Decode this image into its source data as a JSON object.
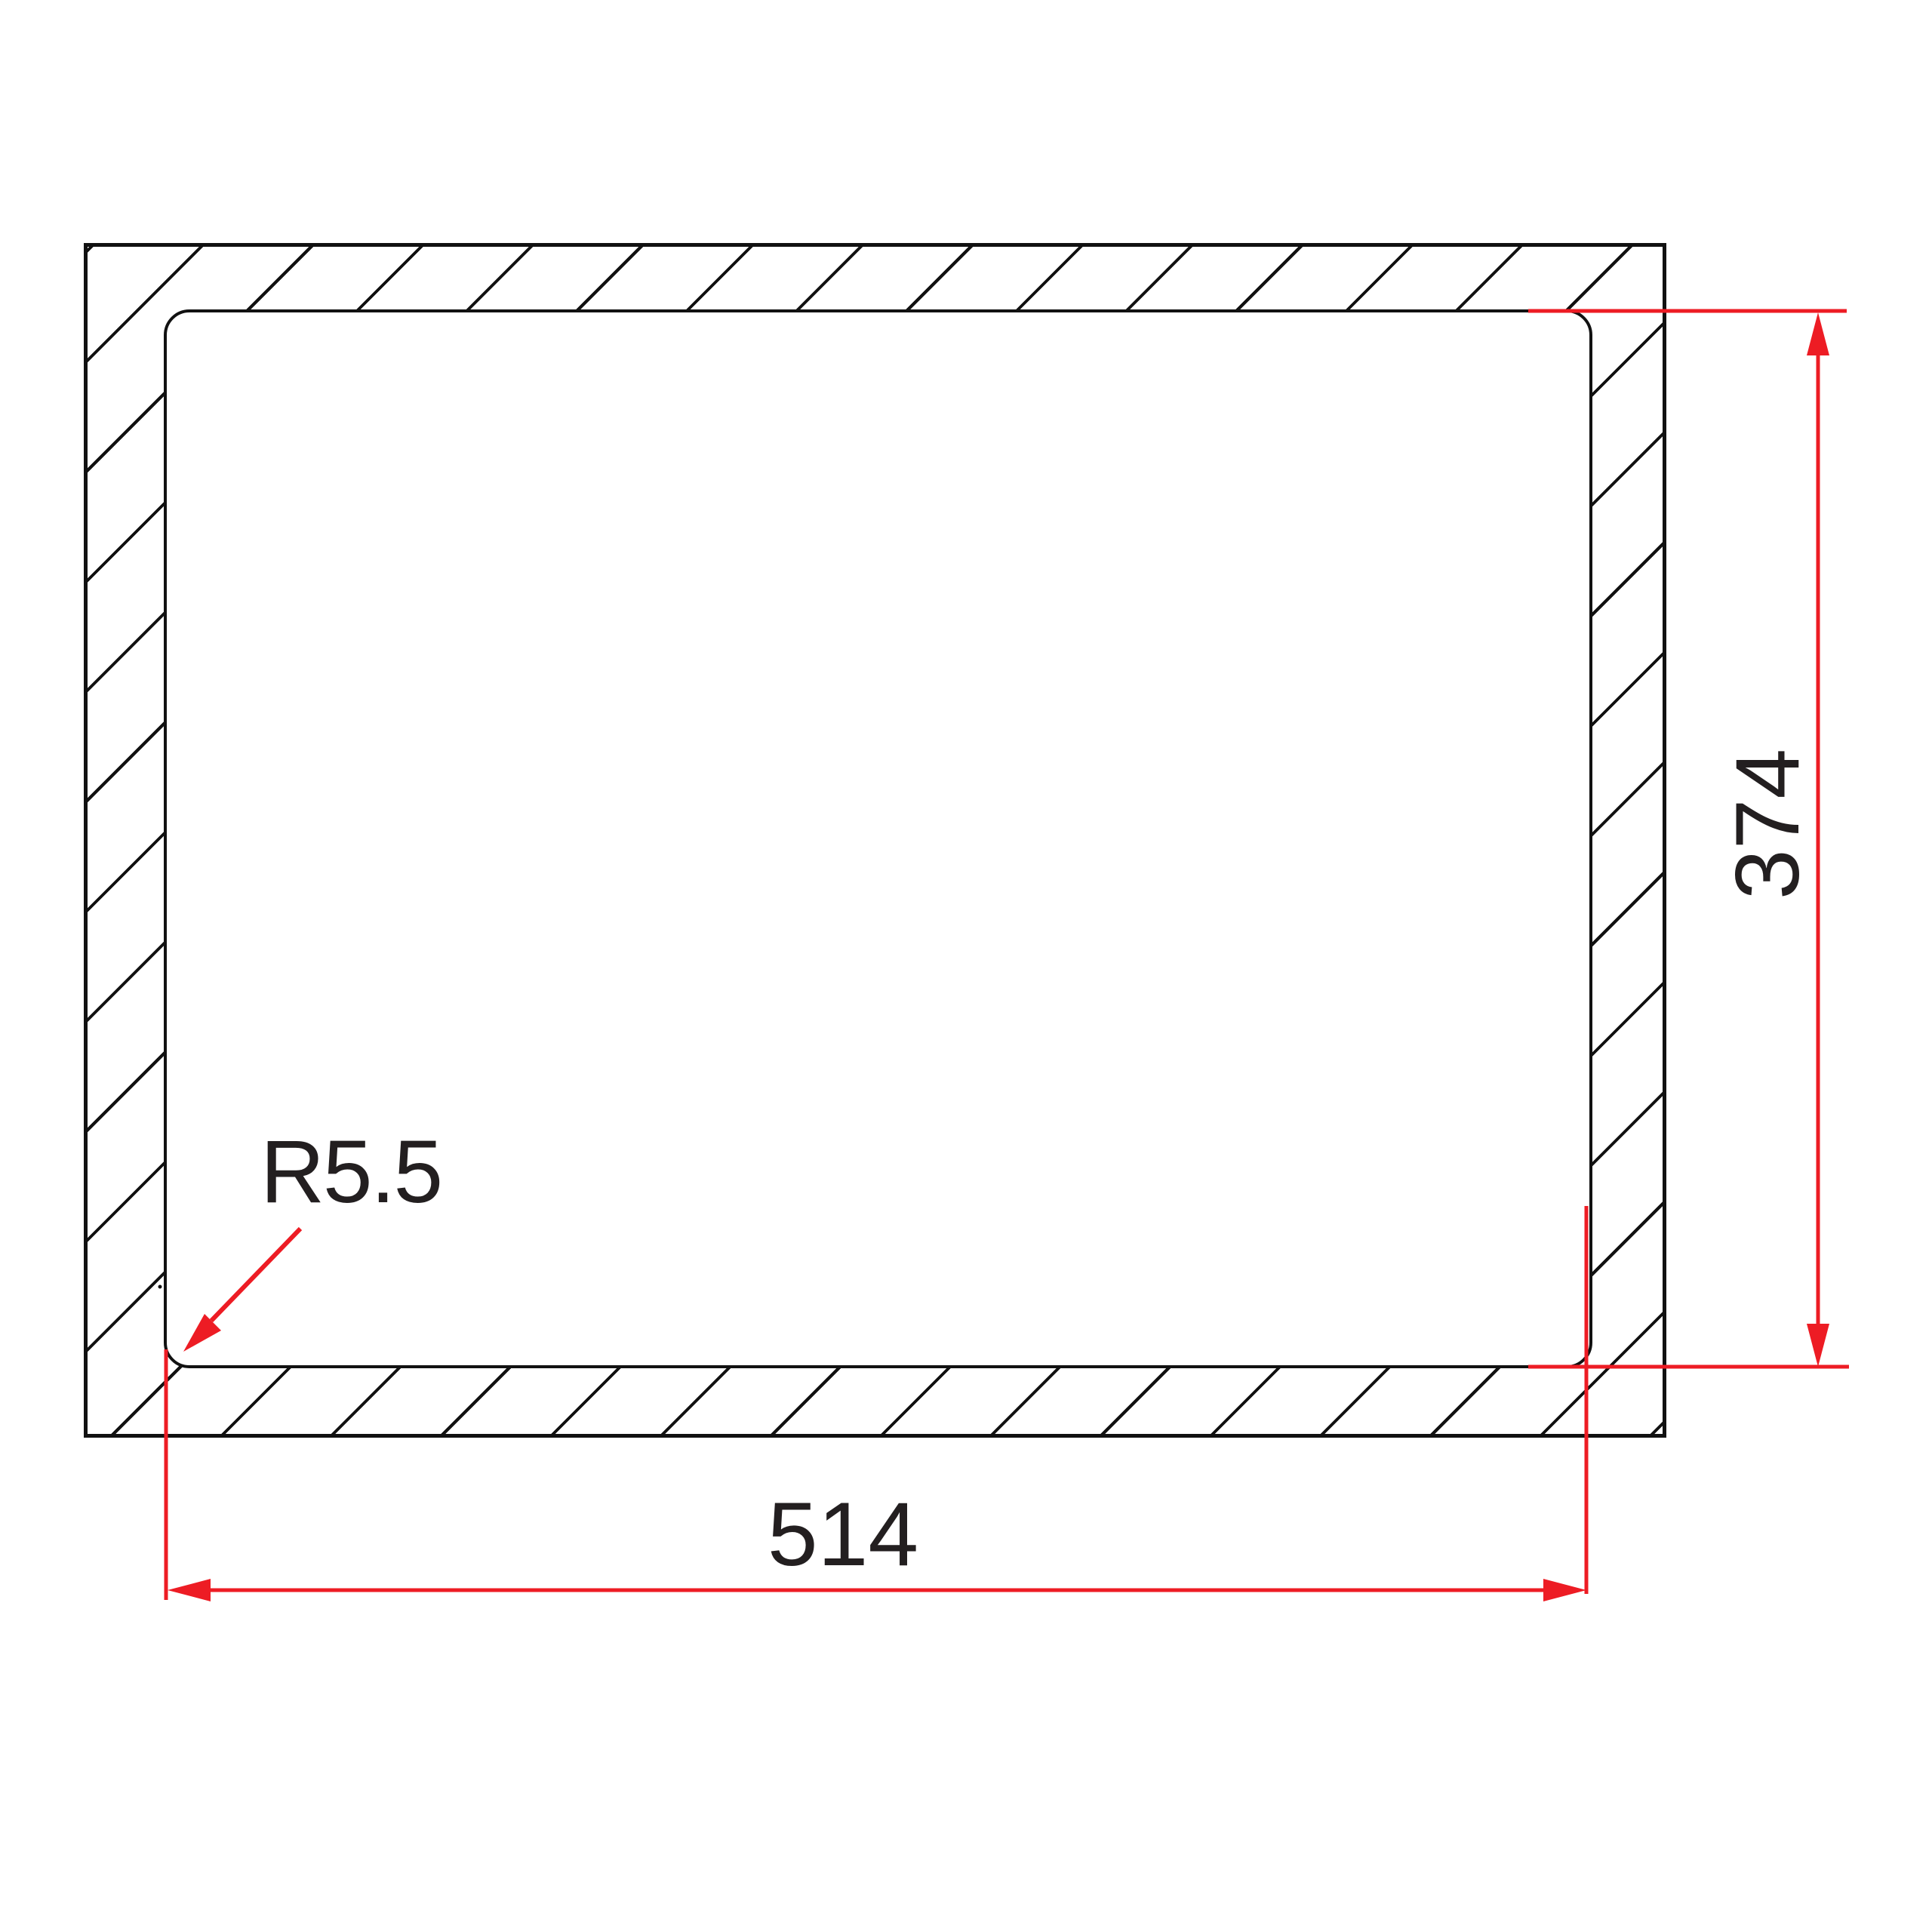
{
  "labels": {
    "height_dimension": "374",
    "width_dimension": "514",
    "corner_radius": "R5.5"
  },
  "colors": {
    "dimension_red": "#ed1c24",
    "line_black": "#111111",
    "text_black": "#231f20",
    "background": "#ffffff"
  }
}
